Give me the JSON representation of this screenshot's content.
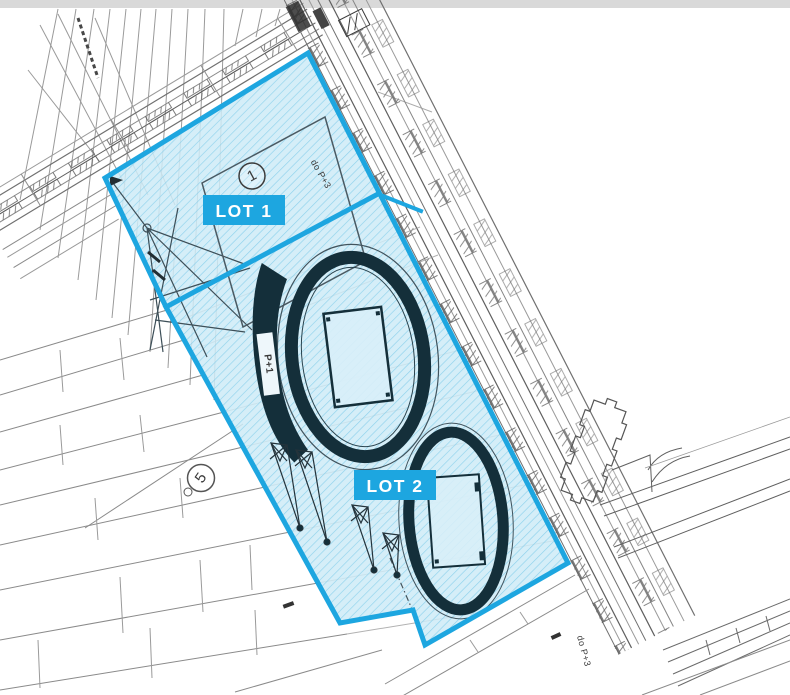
{
  "page": {
    "background": "#ffffff",
    "top_bar_color": "#d9d9d9"
  },
  "plan": {
    "lot1_label": "LOT 1",
    "lot2_label": "LOT 2",
    "annotations": {
      "parcel_number_1": "1",
      "parcel_number_5": "5",
      "zoning_note_upper": "do P+3",
      "zoning_note_lower": "do P+3",
      "grandstand_note": "P+1"
    },
    "colors": {
      "highlight_cyan": "#1da6e0",
      "lot_fill": "#cdeaf6",
      "lot_hatch": "#7dcae9",
      "stadium_dark": "#142f3a",
      "linework_gray": "#8a8a8a"
    }
  }
}
